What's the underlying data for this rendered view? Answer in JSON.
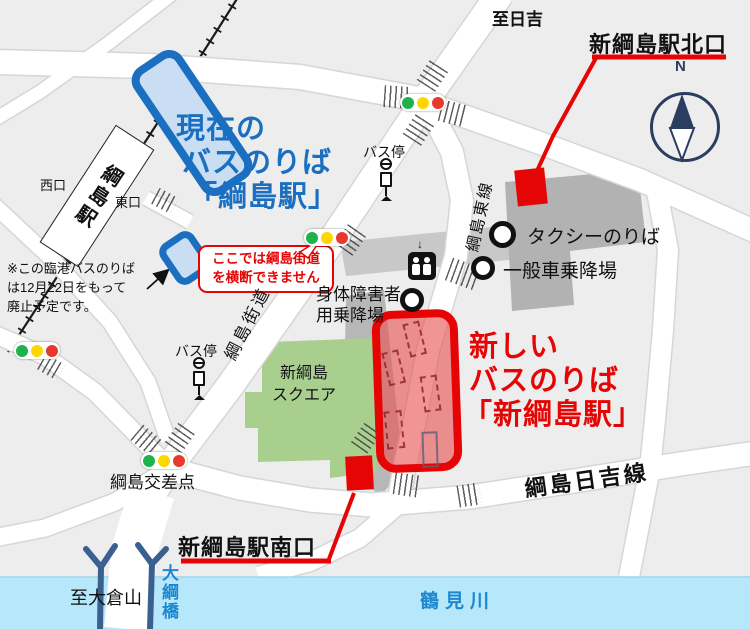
{
  "colors": {
    "background": "#ededed",
    "road": "#ffffff",
    "river": "#b6e7fb",
    "current_accent": "#1b6fc1",
    "current_fill": "#c9def2",
    "new_accent": "#e60505",
    "new_fill": "#ee8484",
    "green_building": "#a9cf8e",
    "gray_building": "#b2b2b2",
    "signal_green": "#1db24b",
    "signal_yellow": "#ffd700",
    "signal_red": "#e8392f",
    "compass_navy": "#2c3e5f",
    "bridge_navy": "#3a6090",
    "river_label_blue": "#1e88cf"
  },
  "current_busstop": {
    "title_line1": "現在の",
    "title_line2": "バスのりば",
    "title_line3": "「綱島駅」",
    "note_line1": "※この臨港バスのりば",
    "note_line2": "は12月22日をもって",
    "note_line3": "廃止予定です。"
  },
  "new_busstop": {
    "title_line1": "新しい",
    "title_line2": "バスのりば",
    "title_line3": "「新綱島駅」"
  },
  "exits": {
    "north": "新綱島駅北口",
    "south": "新綱島駅南口",
    "west": "西口",
    "east": "東口"
  },
  "warning": {
    "line1": "ここでは綱島街道",
    "line2": "を横断できません"
  },
  "facilities": {
    "taxi": "タクシーのりば",
    "general_car": "一般車乗降場",
    "disabled_line1": "身体障害者",
    "disabled_line2": "用乗降場",
    "bus_stop": "バス停",
    "square_line1": "新綱島",
    "square_line2": "スクエア"
  },
  "roads": {
    "kaido": "綱島街道",
    "higashi_line": "綱島東線",
    "hiyoshi_line": "綱島日吉線",
    "intersection": "綱島交差点"
  },
  "places": {
    "station": "綱島駅",
    "to_hiyoshi": "至日吉",
    "to_okurayama": "至大倉山",
    "river": "鶴見川",
    "bridge": "大綱橋"
  },
  "compass": {
    "north": "N"
  }
}
